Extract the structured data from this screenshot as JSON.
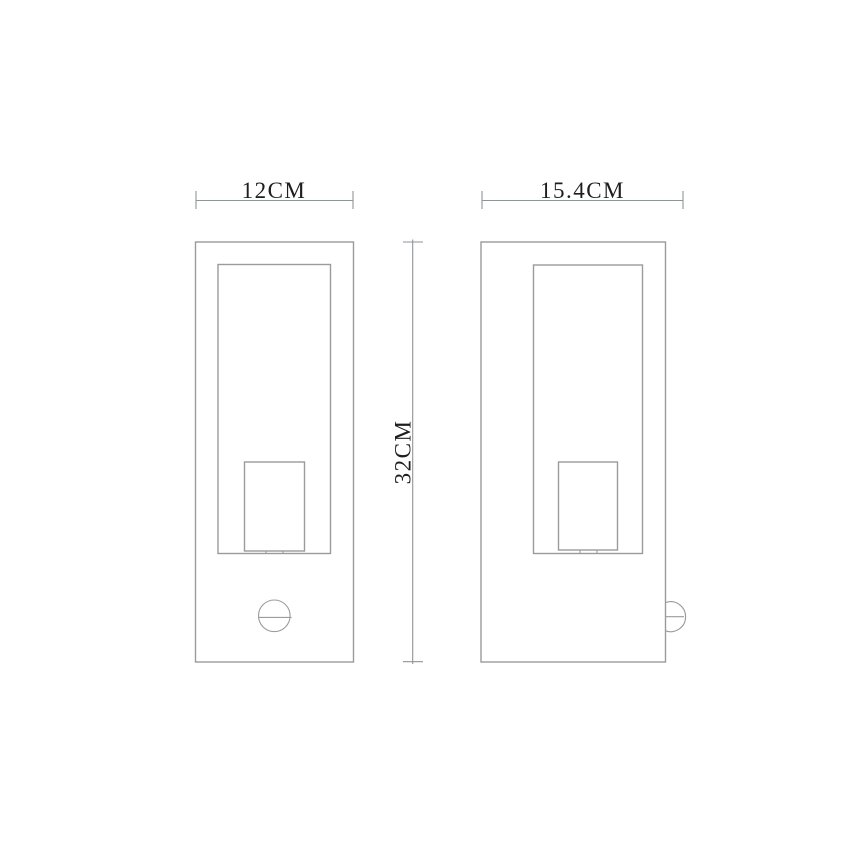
{
  "drawing": {
    "labels": {
      "front_width": "12CM",
      "side_depth": "15.4CM",
      "height": "32CM"
    },
    "colors": {
      "line": "#9b9b9b",
      "dimension_line": "#8f9496",
      "text": "#1e1e1e",
      "background": "#ffffff"
    }
  }
}
